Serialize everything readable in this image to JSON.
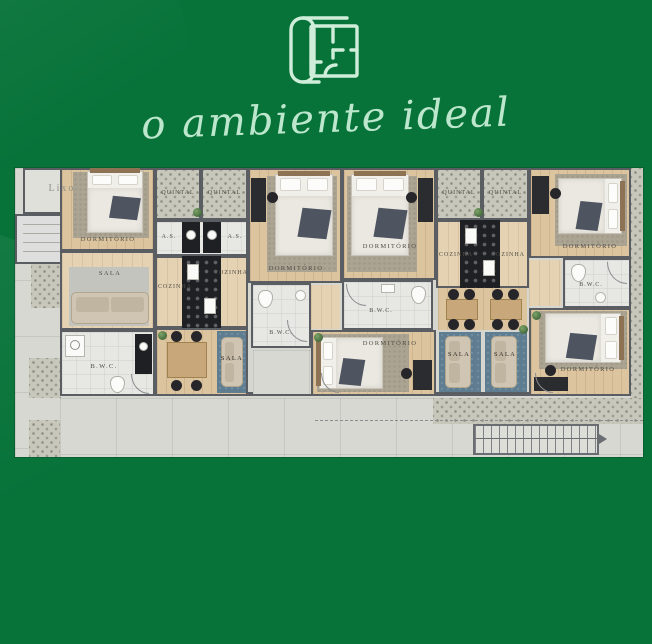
{
  "header": {
    "tagline": "o ambiente ideal",
    "icon": "blueprint-scroll-icon"
  },
  "palette": {
    "background_green": "#077339",
    "accent_mint": "#bce7cd",
    "wall_gray": "#5a5e63",
    "wood_floor": "#dcc49f",
    "counter_black": "#1f2023",
    "rug_blue": "#5e7d90",
    "pattern_tile": "#c7c7bb"
  },
  "plan": {
    "labels": {
      "lixo": "Lixo",
      "dormitorio": "DORMITÓRIO",
      "quintal": "QUINTAL",
      "area_servico": "A.S.",
      "cozinha": "COZINHA",
      "sala": "SALA",
      "banheiro": "B.W.C."
    }
  }
}
